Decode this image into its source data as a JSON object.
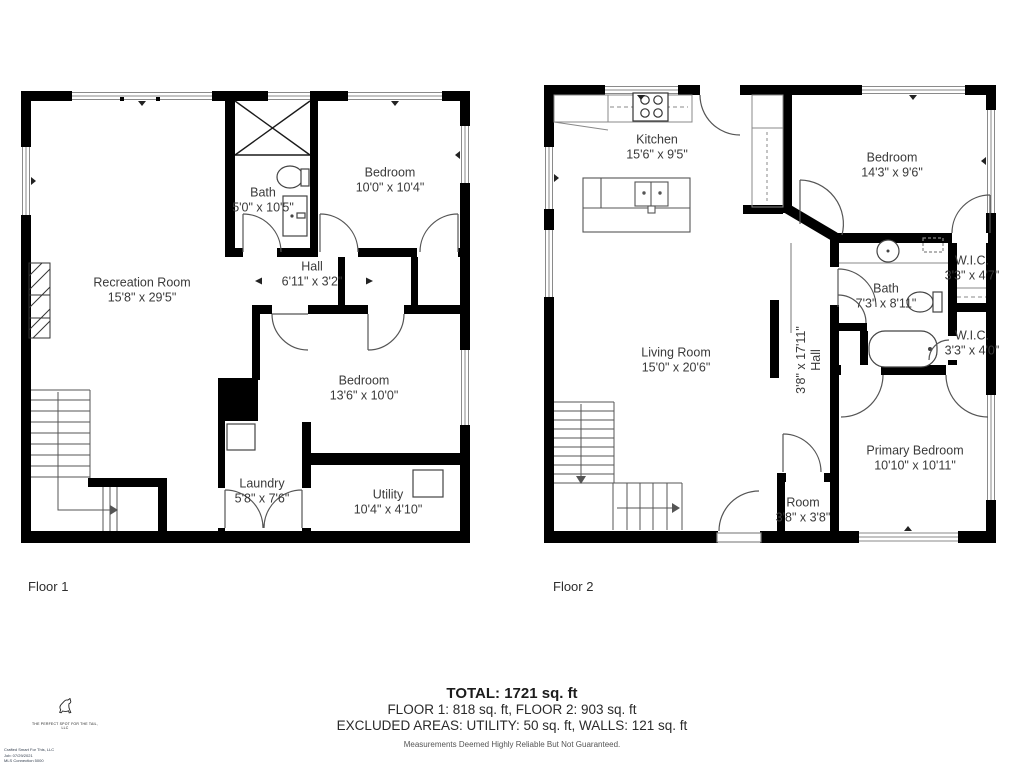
{
  "floor1": {
    "label": "Floor 1",
    "rooms": {
      "recreation": {
        "name": "Recreation Room",
        "dims": "15'8\" x 29'5\""
      },
      "bath": {
        "name": "Bath",
        "dims": "5'0\" x 10'5\""
      },
      "bedroom_top": {
        "name": "Bedroom",
        "dims": "10'0\" x 10'4\""
      },
      "hall": {
        "name": "Hall",
        "dims": "6'11\" x 3'2\""
      },
      "bedroom_mid": {
        "name": "Bedroom",
        "dims": "13'6\" x 10'0\""
      },
      "laundry": {
        "name": "Laundry",
        "dims": "5'8\" x 7'6\""
      },
      "utility": {
        "name": "Utility",
        "dims": "10'4\" x 4'10\""
      }
    }
  },
  "floor2": {
    "label": "Floor 2",
    "rooms": {
      "kitchen": {
        "name": "Kitchen",
        "dims": "15'6\" x 9'5\""
      },
      "bedroom": {
        "name": "Bedroom",
        "dims": "14'3\" x 9'6\""
      },
      "wic_upper": {
        "name": "W.I.C.",
        "dims": "3'3\" x 4'7\""
      },
      "bath": {
        "name": "Bath",
        "dims": "7'3\" x 8'11\""
      },
      "living": {
        "name": "Living Room",
        "dims": "15'0\" x 20'6\""
      },
      "hall": {
        "name": "Hall",
        "dims": "3'8\" x 17'11\""
      },
      "wic_lower": {
        "name": "W.I.C.",
        "dims": "3'3\" x 4'0\""
      },
      "primary": {
        "name": "Primary Bedroom",
        "dims": "10'10\" x 10'11\""
      },
      "room": {
        "name": "Room",
        "dims": "3'8\" x 3'8\""
      }
    }
  },
  "summary": {
    "total": "TOTAL: 1721 sq. ft",
    "floors": "FLOOR 1: 818 sq. ft, FLOOR 2: 903 sq. ft",
    "excluded": "EXCLUDED AREAS: UTILITY: 50 sq. ft, WALLS: 121 sq. ft",
    "disclaimer": "Measurements Deemed Highly Reliable But Not Guaranteed."
  },
  "branding": {
    "logo_icon": "dog-icon",
    "tagline": "THE PERFECT SPOT FOR THE TAIL, LLC",
    "fineprint1": "Crafted Smart For This, LLC",
    "fineprint2": "Job: 07/29/2021",
    "fineprint3": "MLS Connection 5000"
  },
  "colors": {
    "wall": "#000000",
    "label_text": "#3a3a3a",
    "fixture_stroke": "#555555"
  }
}
